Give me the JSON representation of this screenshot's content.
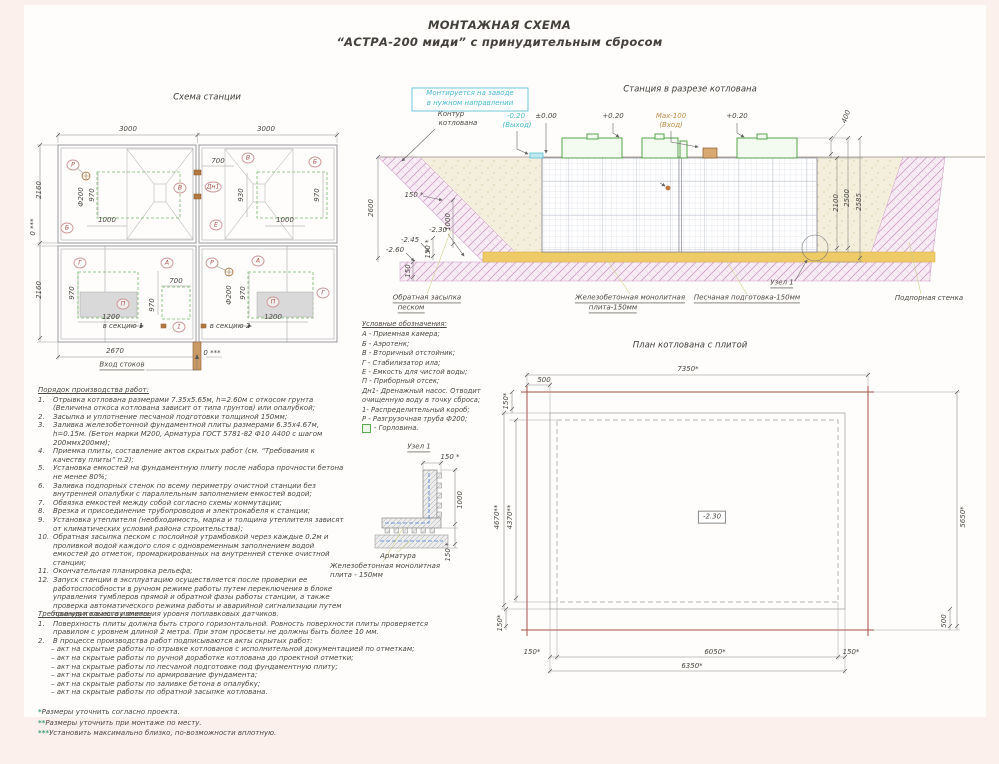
{
  "title": {
    "line1": "МОНТАЖНАЯ СХЕМА",
    "line2": "“АСТРА-200 миди” с принудительным сбросом"
  },
  "palette": {
    "ink": "#4c4843",
    "cyan": "#45b8cc",
    "orange": "#bf8a45",
    "green": "#57a857",
    "red": "#a85048",
    "pink": "#cf9cc6",
    "brown": "#a9703d",
    "yellow": "#eecb66"
  },
  "station_plan": {
    "ann": [
      {
        "t": "Схема станции",
        "x": 177,
        "y": 13,
        "cls": "title"
      },
      {
        "t": "3000",
        "x": 98,
        "y": 45
      },
      {
        "t": "3000",
        "x": 236,
        "y": 45
      },
      {
        "t": "2160",
        "x": 10,
        "y": 105,
        "r": -90
      },
      {
        "t": "0 ***",
        "x": 4,
        "y": 142,
        "r": -90
      },
      {
        "t": "2160",
        "x": 10,
        "y": 205,
        "r": -90
      },
      {
        "t": "Р",
        "x": 43,
        "y": 80,
        "cls": "circ"
      },
      {
        "t": "Б",
        "x": 37,
        "y": 143,
        "cls": "circ"
      },
      {
        "t": "В",
        "x": 150,
        "y": 103,
        "cls": "circ"
      },
      {
        "t": "Ф200",
        "x": 52,
        "y": 112,
        "r": -90
      },
      {
        "t": "970",
        "x": 63,
        "y": 110,
        "r": -90
      },
      {
        "t": "1000",
        "x": 77,
        "y": 136
      },
      {
        "t": "700",
        "x": 188,
        "y": 77
      },
      {
        "t": "В",
        "x": 218,
        "y": 73,
        "cls": "circ"
      },
      {
        "t": "Б",
        "x": 285,
        "y": 77,
        "cls": "circ"
      },
      {
        "t": "Дн1",
        "x": 183,
        "y": 102,
        "cls": "circ"
      },
      {
        "t": "930",
        "x": 212,
        "y": 110,
        "r": -90
      },
      {
        "t": "970",
        "x": 288,
        "y": 110,
        "r": -90
      },
      {
        "t": "Е",
        "x": 186,
        "y": 140,
        "cls": "circ"
      },
      {
        "t": "1000",
        "x": 255,
        "y": 136
      },
      {
        "t": "Г",
        "x": 50,
        "y": 178,
        "cls": "circ"
      },
      {
        "t": "А",
        "x": 137,
        "y": 178,
        "cls": "circ"
      },
      {
        "t": "П",
        "x": 93,
        "y": 219,
        "cls": "circ"
      },
      {
        "t": "970",
        "x": 43,
        "y": 208,
        "r": -90
      },
      {
        "t": "1200",
        "x": 81,
        "y": 233
      },
      {
        "t": "700",
        "x": 146,
        "y": 197
      },
      {
        "t": "970",
        "x": 123,
        "y": 220,
        "r": -90
      },
      {
        "t": "в секцию 1",
        "x": 93,
        "y": 242
      },
      {
        "t": "1",
        "x": 149,
        "y": 242,
        "cls": "circ"
      },
      {
        "t": "Р",
        "x": 182,
        "y": 178,
        "cls": "circ"
      },
      {
        "t": "А",
        "x": 228,
        "y": 176,
        "cls": "circ"
      },
      {
        "t": "Ф200",
        "x": 200,
        "y": 210,
        "r": -90
      },
      {
        "t": "970",
        "x": 214,
        "y": 208,
        "r": -90
      },
      {
        "t": "П",
        "x": 243,
        "y": 217,
        "cls": "circ"
      },
      {
        "t": "1200",
        "x": 243,
        "y": 233
      },
      {
        "t": "Г",
        "x": 293,
        "y": 208,
        "cls": "circ"
      },
      {
        "t": "в секцию 2",
        "x": 200,
        "y": 242
      },
      {
        "t": "2670",
        "x": 85,
        "y": 267
      },
      {
        "t": "0 ***",
        "x": 182,
        "y": 269
      },
      {
        "t": "Вход стоков",
        "x": 92,
        "y": 281,
        "cls": "ul"
      }
    ]
  },
  "section_view": {
    "ann": [
      {
        "t": "Станция в разрезе котлована",
        "x": 325,
        "y": 10,
        "cls": "title"
      },
      {
        "t": "Монтируется на заводе",
        "x": 105,
        "y": 14,
        "c": "cyan"
      },
      {
        "t": "в нужном направлении",
        "x": 105,
        "y": 24,
        "c": "cyan"
      },
      {
        "t": "Контур",
        "x": 86,
        "y": 35
      },
      {
        "t": "котлована",
        "x": 93,
        "y": 44
      },
      {
        "t": "-0.20",
        "x": 151,
        "y": 37,
        "c": "cyan"
      },
      {
        "t": "(Выход)",
        "x": 152,
        "y": 46,
        "c": "cyan"
      },
      {
        "t": "±0.00",
        "x": 181,
        "y": 37
      },
      {
        "t": "+0.20",
        "x": 248,
        "y": 37
      },
      {
        "t": "Мах-100",
        "x": 306,
        "y": 37,
        "c": "orange"
      },
      {
        "t": "(Вход)",
        "x": 306,
        "y": 46,
        "c": "orange"
      },
      {
        "t": "+0.20",
        "x": 372,
        "y": 37
      },
      {
        "t": "400",
        "x": 482,
        "y": 37,
        "r": -70
      },
      {
        "t": "2600",
        "x": 7,
        "y": 128,
        "r": -90
      },
      {
        "t": "2100",
        "x": 472,
        "y": 123,
        "r": -90
      },
      {
        "t": "2500",
        "x": 483,
        "y": 118,
        "r": -90
      },
      {
        "t": "2585",
        "x": 495,
        "y": 122,
        "r": -90
      },
      {
        "t": "150 *",
        "x": 49,
        "y": 116
      },
      {
        "t": "1000",
        "x": 84,
        "y": 142,
        "r": -90
      },
      {
        "t": "150 *",
        "x": 64,
        "y": 169,
        "r": -90
      },
      {
        "t": "-2.30",
        "x": 73,
        "y": 151
      },
      {
        "t": "-2.45",
        "x": 45,
        "y": 161
      },
      {
        "t": "-2.60",
        "x": 30,
        "y": 171
      },
      {
        "t": "150",
        "x": 44,
        "y": 191,
        "r": -90
      },
      {
        "t": "Узел 1",
        "x": 417,
        "y": 204,
        "cls": "ul"
      },
      {
        "t": "Обратная засыпка",
        "x": 62,
        "y": 219,
        "cls": "ul"
      },
      {
        "t": "песком",
        "x": 46,
        "y": 229,
        "cls": "ul"
      },
      {
        "t": "Железобетонная монолитная",
        "x": 265,
        "y": 219,
        "cls": "ul"
      },
      {
        "t": "плита-150мм",
        "x": 248,
        "y": 229,
        "cls": "ul"
      },
      {
        "t": "Песчаная подготовка-150мм",
        "x": 382,
        "y": 219,
        "cls": "ul"
      },
      {
        "t": "Подпорная стенка",
        "x": 564,
        "y": 219
      }
    ]
  },
  "pit_plan": {
    "ann": [
      {
        "t": "План котлована с плитой",
        "x": 210,
        "y": 11,
        "cls": "title"
      },
      {
        "t": "7350*",
        "x": 208,
        "y": 35
      },
      {
        "t": "500",
        "x": 64,
        "y": 46
      },
      {
        "t": "150*",
        "x": 27,
        "y": 66,
        "r": -90
      },
      {
        "t": "4670**",
        "x": 18,
        "y": 182,
        "r": -90
      },
      {
        "t": "4370**",
        "x": 31,
        "y": 182,
        "r": -90
      },
      {
        "t": "5650*",
        "x": 484,
        "y": 182,
        "r": -90
      },
      {
        "t": "-2.30",
        "x": 232,
        "y": 182,
        "cls": "box"
      },
      {
        "t": "150*",
        "x": 21,
        "y": 288,
        "r": -90
      },
      {
        "t": "500",
        "x": 465,
        "y": 286,
        "r": -90
      },
      {
        "t": "150*",
        "x": 52,
        "y": 318
      },
      {
        "t": "6050*",
        "x": 235,
        "y": 318
      },
      {
        "t": "150*",
        "x": 371,
        "y": 318
      },
      {
        "t": "6350*",
        "x": 212,
        "y": 332
      }
    ]
  },
  "node_detail": {
    "ann": [
      {
        "t": "Узел 1",
        "x": 94,
        "y": 8,
        "cls": "ul"
      },
      {
        "t": "150 *",
        "x": 125,
        "y": 18
      },
      {
        "t": "1000",
        "x": 136,
        "y": 60,
        "r": -90
      },
      {
        "t": "150 *",
        "x": 124,
        "y": 112,
        "r": -90
      },
      {
        "t": "Арматура",
        "x": 73,
        "y": 117
      },
      {
        "t": "Железобетонная монолитная",
        "x": 5,
        "y": 127,
        "cls": "left"
      },
      {
        "t": "плита - 150мм",
        "x": 5,
        "y": 136,
        "cls": "left"
      }
    ]
  },
  "legend": {
    "title": "Условные обозначения:",
    "items": [
      "А - Приемная камера;",
      "Б - Аэротенк;",
      "В - Вторичный отстойник;",
      "Г - Стабилизатор ила;",
      "Е - Емкость для чистой воды;",
      "П - Приборный отсек;",
      "Дн1- Дренажный насос. Отводит",
      "очищенную воду в точку сброса;",
      "1- Распределительный короб;",
      "Р - Разгрузочная труба Ф200;",
      {
        "icon": "square",
        "text": "- Горловина."
      }
    ]
  },
  "work_order": {
    "title": "Порядок производства работ:",
    "items": [
      "Отрывка котлована размерами 7.35х5.65м, h=2.60м с откосом грунта (Величина откоса котлована зависит от типа грунтов) или опалубкой;",
      "Засыпка и уплотнение песчаной подготовки толщиной 150мм;",
      "Заливка железобетонной фундаментной плиты размерами 6.35х4.67м, h=0.15м. (Бетон марки М200, Арматура ГОСТ 5781-82 Ф10 А400 с шагом 200ммх200мм);",
      "Приемка плиты, составление актов скрытых работ (см. “Требования к качеству плиты” п.2);",
      "Установка емкостей на фундаментную плиту после набора прочности бетона не менее 80%;",
      "Заливка подпорных стенок по всему периметру очистной станции без внутренней опалубки с параллельным заполнением емкостей водой;",
      "Обвязка емкостей между собой согласно схемы коммутации;",
      "Врезка и присоединение трубопроводов и электрокабеля к станции;",
      "Установка утеплителя (необходимость, марка и толщина утеплителя зависят от климатических условий района строительства);",
      "Обратная засыпка песком с послойной утрамбовкой через каждые 0.2м и проливкой водой каждого слоя с одновременным заполнением водой емкостей до отметок, промаркированных на внутренней стенке очистной станции;",
      "Окончательная планировка рельефа;",
      "Запуск станции в эксплуатацию осуществляется после проверки ее работоспособности в ручном режиме работы путем переключения в блоке управления тумблеров прямой и обратной фазы работы станции, а также проверка автоматического режима работы и аварийной сигнализации путем принудительного изменения уровня поплавковых датчиков."
    ]
  },
  "quality": {
    "title": "Требования к качеству плиты:",
    "items": [
      "Поверхность плиты должна быть строго горизонтальной. Ровность поверхности плиты проверяется правилом с уровнем длиной 2 метра. При этом просветы не должны быть более 10 мм.",
      "В процессе производства работ подписываются акты скрытых работ:"
    ],
    "subs": [
      "– акт на скрытые работы по отрывке котлованов с исполнительной документацией по отметкам;",
      "– акт на скрытые работы по ручной доработке котлована до проектной отметки;",
      "– акт на скрытые работы по песчаной подготовке под фундаментную плиту;",
      "– акт на скрытые работы по армирование фундамента;",
      "– акт на скрытые работы по заливке бетона в опалубку;",
      "– акт на скрытые работы по обратной засыпке котлована."
    ]
  },
  "footnotes": {
    "items": [
      {
        "m": "*",
        "t": "Размеры уточнить согласно проекта."
      },
      {
        "m": "**",
        "t": "Размеры уточнить при монтаже по месту."
      },
      {
        "m": "***",
        "t": "Установить максимально близко, по-возможности вплотную."
      }
    ]
  }
}
